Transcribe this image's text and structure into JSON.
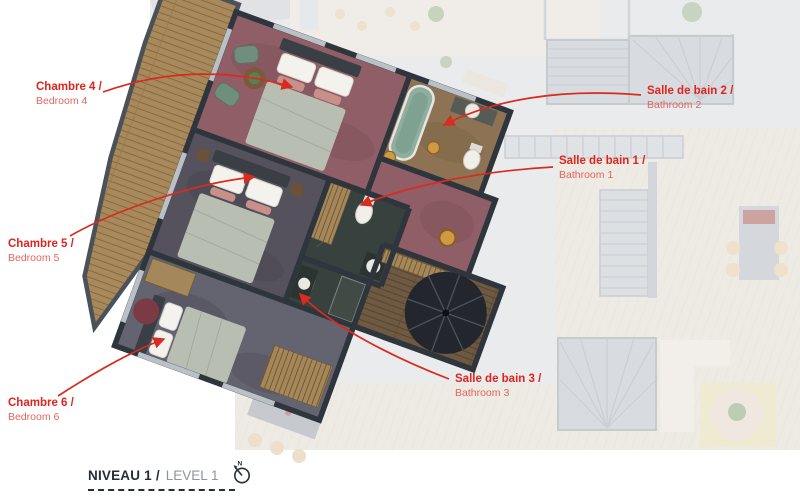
{
  "page": {
    "background": "#ffffff"
  },
  "labels": {
    "rooms": [
      {
        "id": "bedroom-4",
        "fr": "Chambre 4 /",
        "en": "Bedroom 4"
      },
      {
        "id": "bedroom-5",
        "fr": "Chambre 5 /",
        "en": "Bedroom 5"
      },
      {
        "id": "bedroom-6",
        "fr": "Chambre 6 /",
        "en": "Bedroom 6"
      },
      {
        "id": "bathroom-2",
        "fr": "Salle de bain 2 /",
        "en": "Bathroom 2"
      },
      {
        "id": "bathroom-1",
        "fr": "Salle de bain 1 /",
        "en": "Bathroom 1"
      },
      {
        "id": "bathroom-3",
        "fr": "Salle de bain 3 /",
        "en": "Bathroom 3"
      }
    ]
  },
  "footer": {
    "level_fr": "NIVEAU 1 /",
    "level_en": "LEVEL 1",
    "north_letter": "N"
  },
  "icons": {
    "north": "north-compass-icon"
  },
  "colors": {
    "label_red": "#e0241d",
    "label_red_light": "#e4655c",
    "leader_red": "#d92b1f",
    "title_dark": "#272e38",
    "title_gray": "#8f959e",
    "carpet_burgundy": "#8f5e66",
    "carpet_slate": "#55525d",
    "carpet_gray": "#646370",
    "deck_wood": "#a8895c",
    "hall_wood": "#6e5942",
    "marble_dark": "#37413d",
    "wall_dark": "#2f353d",
    "tub_green": "#8fae9f",
    "faded_base": "#d5d8db"
  }
}
